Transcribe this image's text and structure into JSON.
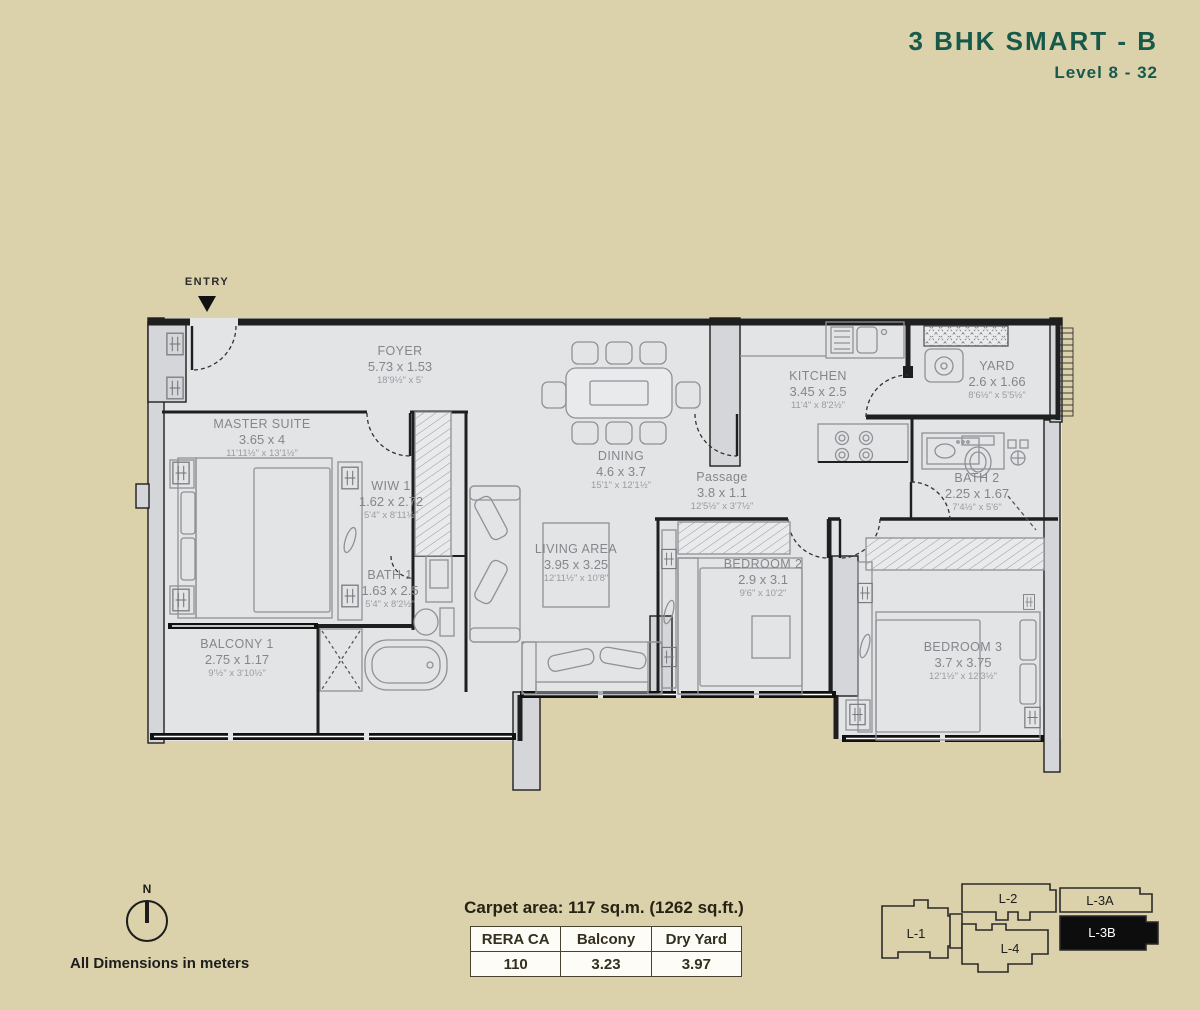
{
  "title": {
    "name": "3 BHK SMART - B",
    "level": "Level 8 - 32"
  },
  "entry_label": "ENTRY",
  "north_label": "N",
  "dimensions_note": "All Dimensions in meters",
  "carpet_area": {
    "summary": "Carpet area: 117 sq.m. (1262 sq.ft.)",
    "table": {
      "headers": [
        "RERA CA",
        "Balcony",
        "Dry Yard"
      ],
      "values": [
        "110",
        "3.23",
        "3.97"
      ]
    }
  },
  "rooms": [
    {
      "name": "FOYER",
      "m": "5.73 x 1.53",
      "ft": "18'9½\" x 5'"
    },
    {
      "name": "MASTER SUITE",
      "m": "3.65 x 4",
      "ft": "11'11½\" x 13'1½\""
    },
    {
      "name": "WIW 1",
      "m": "1.62 x 2.72",
      "ft": "5'4\" x 8'11½\""
    },
    {
      "name": "BATH 1",
      "m": "1.63 x 2.5",
      "ft": "5'4\" x 8'2½\""
    },
    {
      "name": "BALCONY 1",
      "m": "2.75 x 1.17",
      "ft": "9'½\" x 3'10½\""
    },
    {
      "name": "DINING",
      "m": "4.6 x 3.7",
      "ft": "15'1\" x 12'1½\""
    },
    {
      "name": "LIVING AREA",
      "m": "3.95 x 3.25",
      "ft": "12'11½\" x 10'8\""
    },
    {
      "name": "Passage",
      "m": "3.8 x 1.1",
      "ft": "12'5½\" x 3'7½\""
    },
    {
      "name": "KITCHEN",
      "m": "3.45 x 2.5",
      "ft": "11'4\" x 8'2½\""
    },
    {
      "name": "YARD",
      "m": "2.6 x 1.66",
      "ft": "8'6½\" x 5'5½\""
    },
    {
      "name": "BATH 2",
      "m": "2.25 x 1.67",
      "ft": "7'4½\" x 5'6\""
    },
    {
      "name": "BEDROOM 2",
      "m": "2.9 x 3.1",
      "ft": "9'6\" x 10'2\""
    },
    {
      "name": "BEDROOM 3",
      "m": "3.7 x 3.75",
      "ft": "12'1½\" x 12'3½\""
    }
  ],
  "keyplan": {
    "buildings": [
      "L-1",
      "L-2",
      "L-3A",
      "L-3B",
      "L-4"
    ],
    "highlighted": "L-3B"
  },
  "colors": {
    "background": "#dbd1ab",
    "floor": "#e3e4e6",
    "wall_fill": "#d5d6d9",
    "ink": "#1f1f1f",
    "label_gray": "#85868c",
    "title_green": "#175a4a",
    "highlight_black": "#0d0d0d"
  }
}
